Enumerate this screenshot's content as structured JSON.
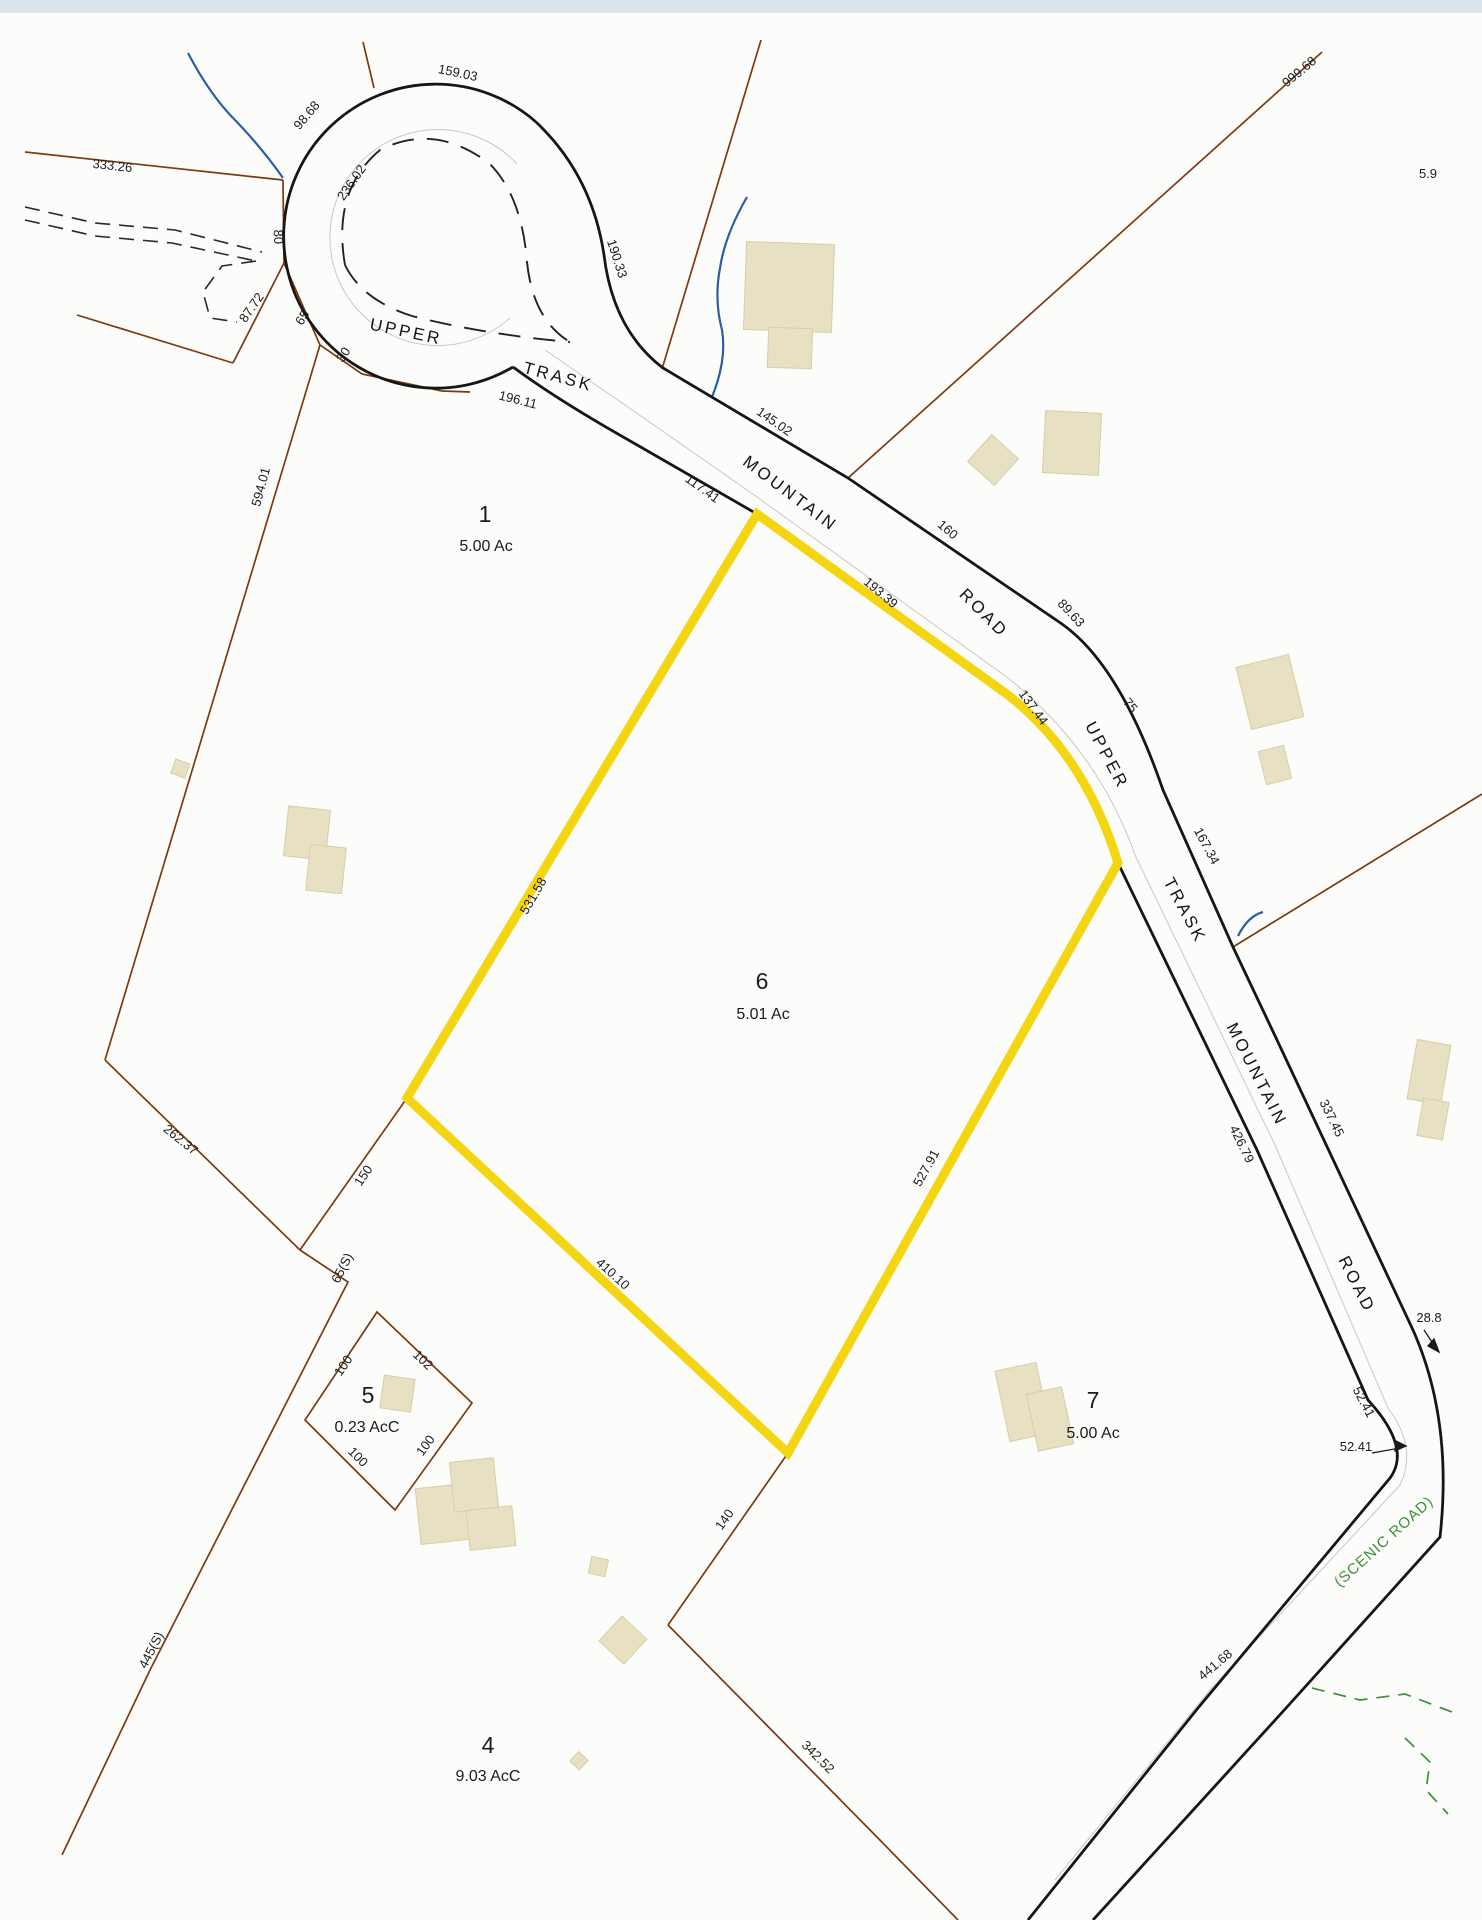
{
  "map_title": "parcel survey map",
  "colors": {
    "highlight_yellow": "#F4D512",
    "boundary_brown": "#7C3A10",
    "road_black": "#161616",
    "water_blue": "#2B5FA5",
    "building_tan": "#E8E0C2",
    "scenic_green": "#3F8F3A",
    "pavement_gray": "#C8C8C8",
    "scan_strip": "#DBE4EB"
  },
  "road_labels": [
    "UPPER",
    "TRASK",
    "MOUNTAIN",
    "ROAD",
    "UPPER",
    "TRASK",
    "MOUNTAIN",
    "ROAD"
  ],
  "scenic_road_label": "(SCENIC ROAD)",
  "parcels": [
    {
      "number": "1",
      "area": "5.00 Ac",
      "highlighted": false
    },
    {
      "number": "6",
      "area": "5.01 Ac",
      "highlighted": true
    },
    {
      "number": "5",
      "area": "0.23 AcC",
      "highlighted": false
    },
    {
      "number": "7",
      "area": "5.00 Ac",
      "highlighted": false
    },
    {
      "number": "4",
      "area": "9.03 AcC",
      "highlighted": false
    }
  ],
  "dimensions": [
    "159.03",
    "98.68",
    "333.26",
    "236.02",
    "190.33",
    "80",
    "87.72",
    "65",
    "30",
    "196.11",
    "145.02",
    "117.41",
    "160",
    "89.63",
    "193.39",
    "137.44",
    "75",
    "167.34",
    "337.45",
    "426.79",
    "999.68",
    "5.9",
    "28.8",
    "52.41",
    "52.41",
    "441.68",
    "531.58",
    "594.01",
    "262.37",
    "150",
    "65(S)",
    "445(S)",
    "410.10",
    "527.91",
    "140",
    "342.52",
    "100",
    "102",
    "100",
    "100"
  ]
}
